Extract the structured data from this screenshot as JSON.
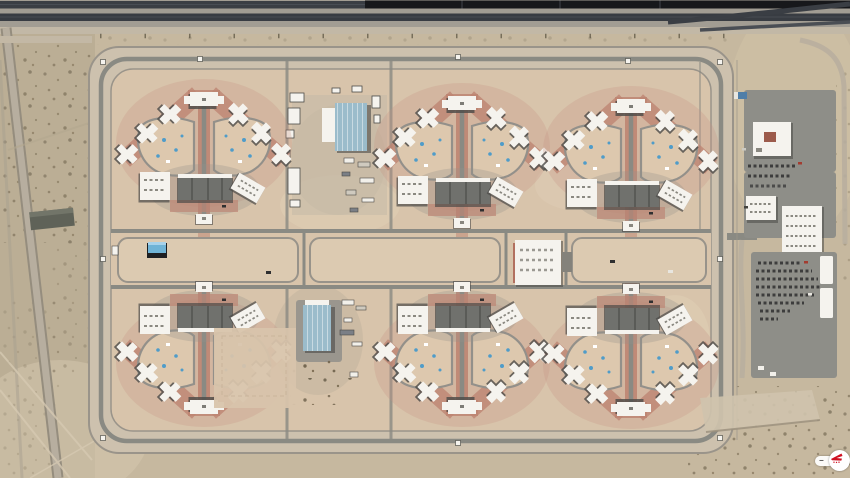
{
  "map_viewer": {
    "zoom_out_label": "−",
    "zoom_in_label": "+",
    "logo_icon": "compass-logo-icon"
  },
  "scene": {
    "type": "satellite-aerial-photograph",
    "subject": "desert correctional complex with six radial cell-block clusters, perimeter roads, railroad corridor at top and staff entrance parking at right",
    "cluster_count": 6,
    "cluster_layout": "2 rows x 3 columns, bottom row mirrored, bottom-left cluster partially built"
  },
  "palette": {
    "desertBase": "#c6b89f",
    "desertDark": "#b3a68c",
    "scrubDot": "#6b5f4a",
    "railGravel": "#a29d93",
    "railDark": "#3a3e44",
    "trainDark": "#17181b",
    "asphaltLight": "#b7ae9f",
    "bufferZone": "#cdc1ae",
    "complexGround": "#d8c4ab",
    "roadGray": "#8a8a83",
    "fenceLine": "#9a948a",
    "redPath": "#bd8371",
    "redSoft": "#c79384",
    "courtyardTan": "#ddc8ae",
    "walkwayGray": "#93908a",
    "buildingWhite": "#f5f3ee",
    "buildingShadow": "#4b4a47",
    "grayRoof": "#70716d",
    "grayRoofDark": "#5a5b57",
    "warehouseBlue": "#9bbccb",
    "poolBlue": "#4f9cc9",
    "parkingGray": "#8e8e88",
    "carDark": "#2f2f30",
    "logoRed": "#cf1020",
    "uiText": "#4a4a4a",
    "uiWhite": "#ffffff"
  }
}
